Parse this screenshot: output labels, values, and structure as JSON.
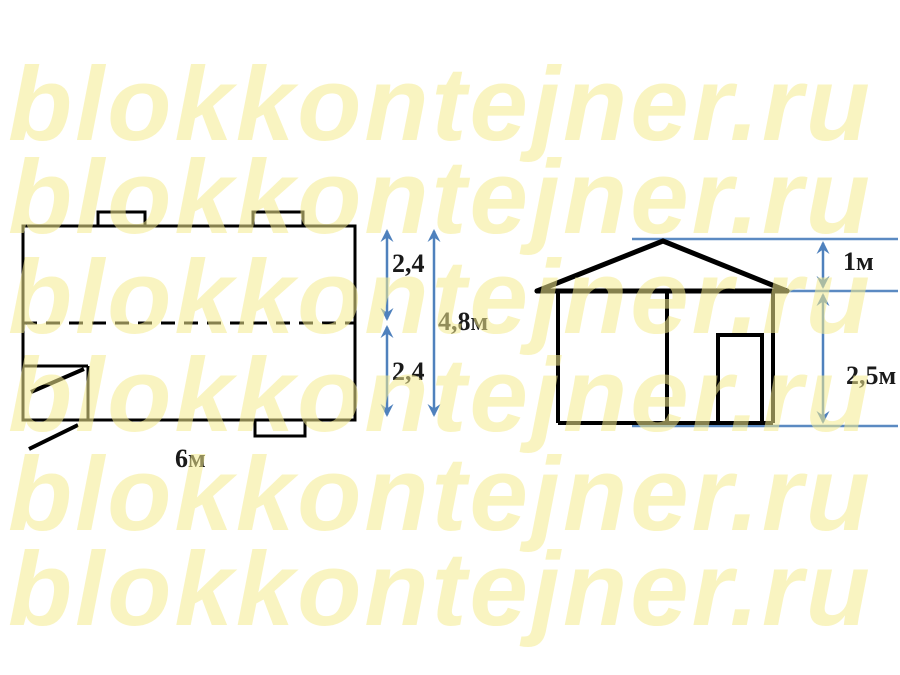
{
  "watermark": {
    "text": "blokkontejner.ru",
    "color": "#f5ec8f",
    "opacity": 0.55,
    "rows": 6
  },
  "colors": {
    "background": "#ffffff",
    "ink": "#000000",
    "dimension_blue": "#4f81bd",
    "guide_blue": "#5b8ac2",
    "label_ink": "#1a1a1a",
    "wm_color": "#f5ec8f"
  },
  "plan_view": {
    "labels": {
      "upper_height": "2,4",
      "lower_height": "2,4",
      "total_height": "4,8м",
      "width": "6м"
    }
  },
  "elevation_view": {
    "labels": {
      "roof_height": "1м",
      "wall_height": "2,5м"
    }
  }
}
